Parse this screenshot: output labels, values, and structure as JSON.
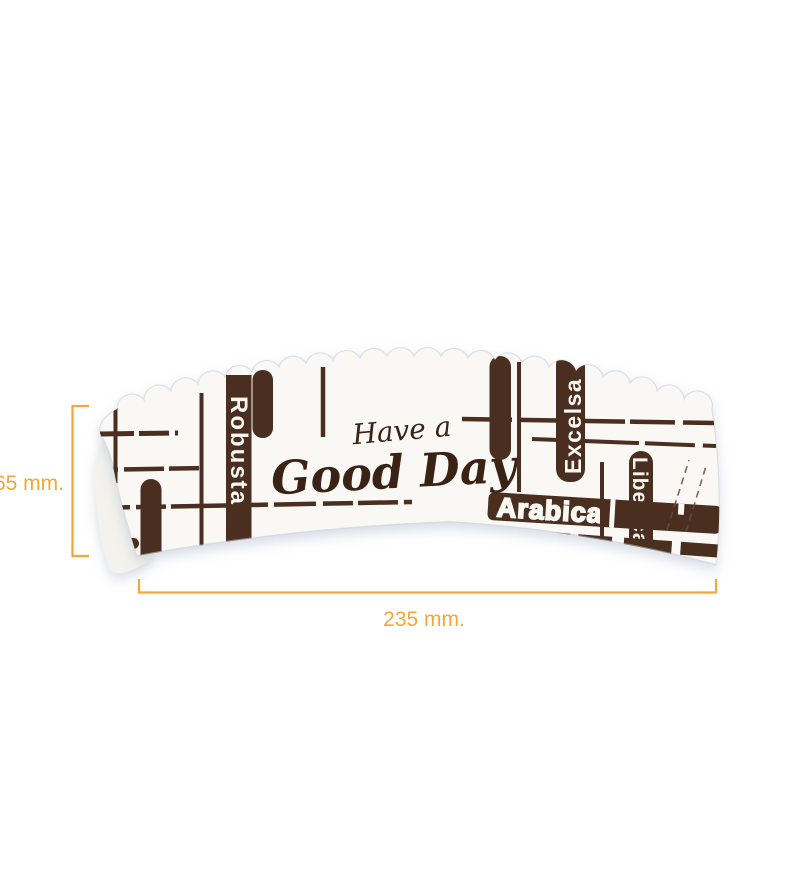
{
  "sleeve": {
    "script_line1": "Have a",
    "script_line2": "Good Day",
    "labels": {
      "robusta": "Robusta",
      "excelsa": "Excelsa",
      "liberica": "Liberica",
      "arabica": "Arabica"
    }
  },
  "dimensions": {
    "height": "65 mm.",
    "width": "235 mm."
  },
  "colors": {
    "accent_orange": "#F4A63B",
    "print_brown": "#4A2E1F",
    "script_brown": "#3A2214",
    "sleeve_white": "#F9F8F4",
    "label_white": "#FAF8F3"
  }
}
